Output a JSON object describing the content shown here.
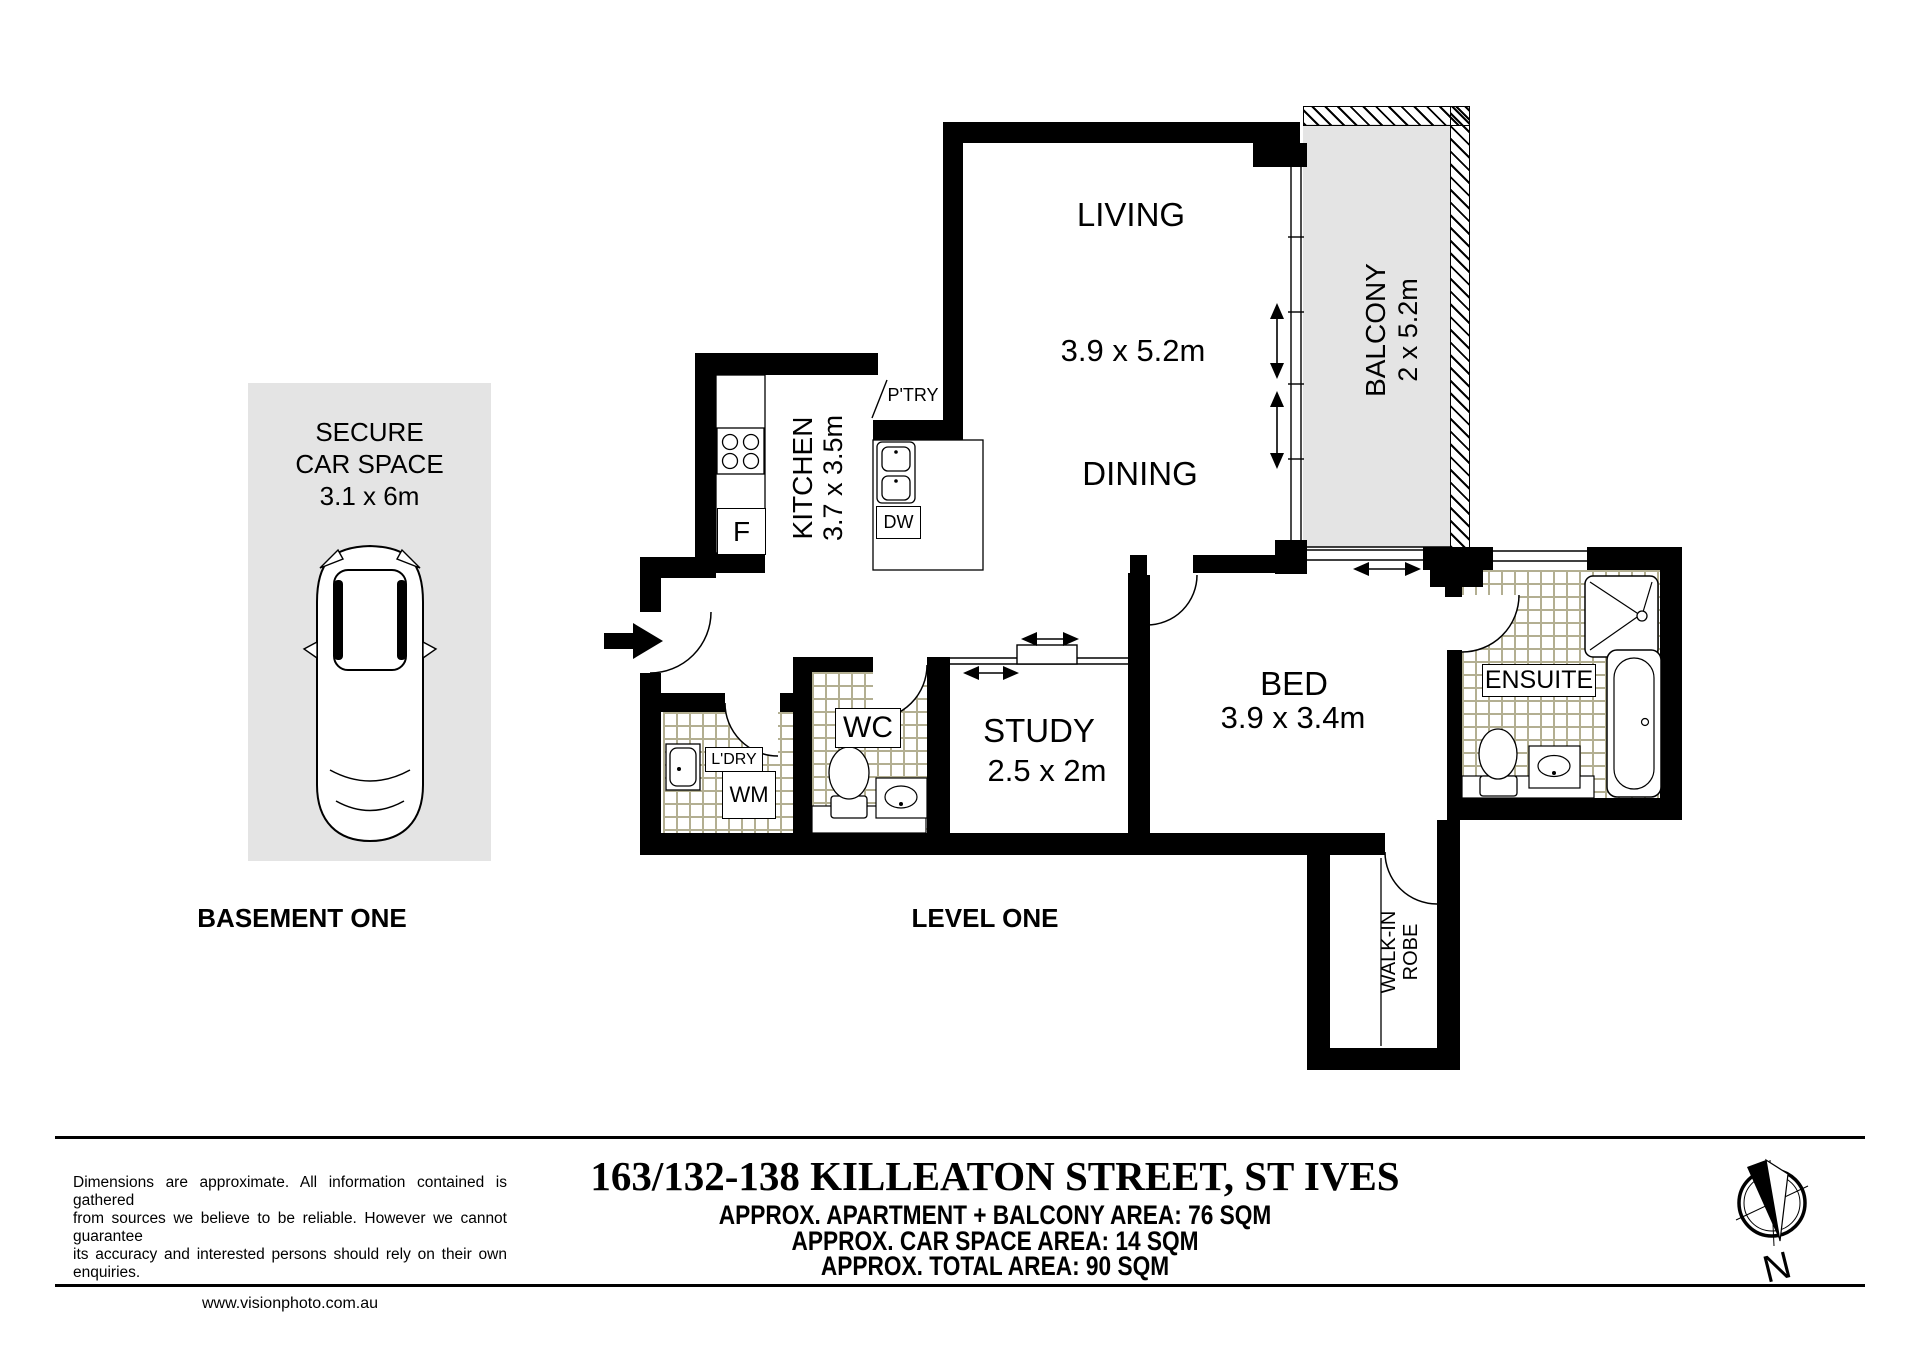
{
  "plan": {
    "basement_label": "BASEMENT ONE",
    "level_label": "LEVEL ONE",
    "car_space": {
      "line1": "SECURE",
      "line2": "CAR SPACE",
      "dims": "3.1 x 6m"
    },
    "rooms": {
      "living": {
        "label": "LIVING",
        "dims": "3.9 x 5.2m"
      },
      "dining": {
        "label": "DINING"
      },
      "balcony": {
        "label": "BALCONY",
        "dims": "2 x 5.2m"
      },
      "kitchen": {
        "label": "KITCHEN",
        "dims": "3.7 x 3.5m"
      },
      "pantry": {
        "label": "P'TRY"
      },
      "study": {
        "label": "STUDY",
        "dims": "2.5 x 2m"
      },
      "bed": {
        "label": "BED",
        "dims": "3.9 x 3.4m"
      },
      "ensuite": {
        "label": "ENSUITE"
      },
      "wc": {
        "label": "WC"
      },
      "laundry": {
        "label": "L'DRY"
      },
      "walk_in_robe": {
        "line1": "WALK-IN",
        "line2": "ROBE"
      }
    },
    "appliances": {
      "fridge": "F",
      "dishwasher": "DW",
      "washing_machine": "WM"
    }
  },
  "footer": {
    "disclaimer": [
      "Dimensions are approximate.  All information contained is gathered",
      "from sources we believe to be reliable.  However we cannot guarantee",
      "its accuracy and interested persons should rely on their own enquiries."
    ],
    "website": "www.visionphoto.com.au",
    "address": "163/132-138 KILLEATON STREET, ST IVES",
    "areas": [
      "APPROX. APARTMENT + BALCONY AREA: 76 SQM",
      "APPROX. CAR SPACE AREA: 14 SQM",
      "APPROX. TOTAL AREA: 90 SQM"
    ],
    "compass": "N"
  },
  "colors": {
    "wall": "#000000",
    "area_fill": "#e4e4e4",
    "tile_line": "#b3af92"
  }
}
